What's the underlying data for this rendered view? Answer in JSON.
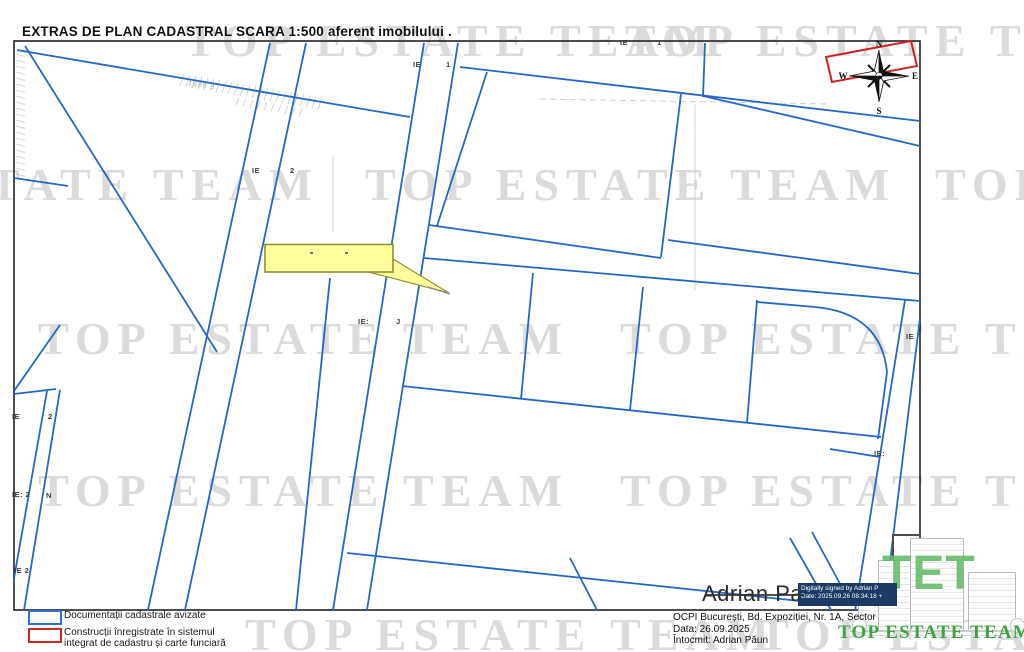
{
  "page": {
    "title": "EXTRAS DE PLAN CADASTRAL SCARA 1:500 aferent imobilului ."
  },
  "colors": {
    "parcel_line": "#2468c4",
    "frame": "#222222",
    "construction_line": "#cc2222",
    "callout_fill": "#ffff9c",
    "callout_border": "#90902e",
    "watermark": "#dbdbdb",
    "logo_green": "#3fa344",
    "digital_badge_bg": "#1c3a67"
  },
  "watermark": {
    "text": "TOP ESTATE TEAM",
    "instances": [
      {
        "x": 185,
        "y": 14
      },
      {
        "x": 625,
        "y": 14
      },
      {
        "x": -212,
        "y": 158
      },
      {
        "x": 365,
        "y": 158
      },
      {
        "x": 935,
        "y": 158
      },
      {
        "x": 38,
        "y": 312
      },
      {
        "x": 620,
        "y": 312
      },
      {
        "x": 38,
        "y": 464
      },
      {
        "x": 620,
        "y": 464
      },
      {
        "x": 245,
        "y": 608
      },
      {
        "x": 758,
        "y": 608
      }
    ]
  },
  "compass": {
    "north": "N",
    "south": "S",
    "east": "E",
    "west": "W"
  },
  "map_labels": [
    {
      "x": 252,
      "y": 166,
      "text": "IE"
    },
    {
      "x": 290,
      "y": 166,
      "text": "2"
    },
    {
      "x": 413,
      "y": 60,
      "text": "IE"
    },
    {
      "x": 446,
      "y": 60,
      "text": "1"
    },
    {
      "x": 620,
      "y": 38,
      "text": "IE"
    },
    {
      "x": 657,
      "y": 38,
      "text": "1"
    },
    {
      "x": 358,
      "y": 317,
      "text": "IE:"
    },
    {
      "x": 396,
      "y": 317,
      "text": "J"
    },
    {
      "x": 12,
      "y": 412,
      "text": "IE"
    },
    {
      "x": 48,
      "y": 412,
      "text": "2"
    },
    {
      "x": 12,
      "y": 490,
      "text": "IE: 2"
    },
    {
      "x": 46,
      "y": 491,
      "text": "N"
    },
    {
      "x": 14,
      "y": 566,
      "text": "IE 2"
    },
    {
      "x": 874,
      "y": 449,
      "text": "IE:"
    },
    {
      "x": 906,
      "y": 332,
      "text": "IE"
    }
  ],
  "sketch": {
    "area_label": "1688 a"
  },
  "legend": {
    "items": [
      {
        "label_lines": [
          "Documentații cadastrale avizate"
        ]
      },
      {
        "label_lines": [
          "Construcții înregistrate în sistemul",
          "integrat de cadastru și carte funciară"
        ]
      }
    ]
  },
  "signature": {
    "name": "Adrian Paun",
    "digital_line1": "Digitally signed by Adrian P",
    "digital_line2": "Date: 2025.09.26 08:34:18 +"
  },
  "footer": {
    "address": "OCPI București, Bd. Expoziției, Nr. 1A, Sector",
    "date": "Data: 26.09.2025",
    "author": "Întocmit: Adrian Păun"
  },
  "logo": {
    "monogram": "TET",
    "name": "TOP ESTATE TEAM"
  }
}
